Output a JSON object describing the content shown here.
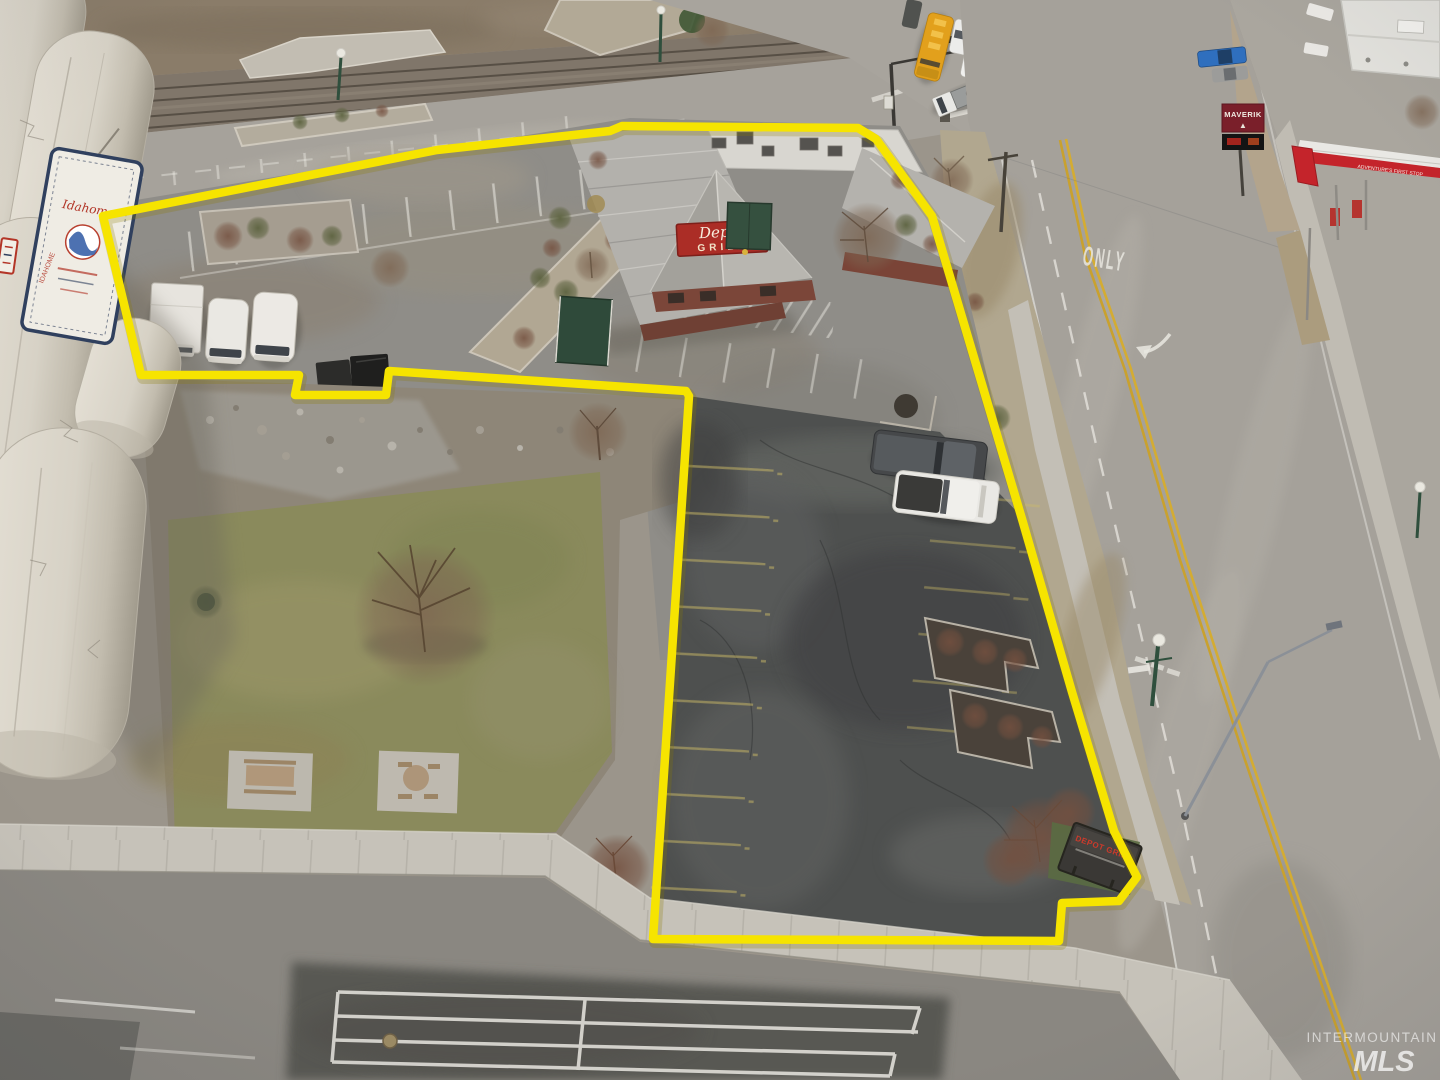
{
  "photo": {
    "type": "aerial-drone-photo",
    "subject": "Commercial property outlined in yellow: Depot Grill restaurant, parking lots, park lawn and grain silos at a street corner"
  },
  "watermark": {
    "line1": "INTERMOUNTAIN",
    "line2": "MLS"
  },
  "boundary": {
    "color": "#f6e400",
    "points": "103,216 437,150 610,131 622,126 858,128 876,139 932,216 1022,519 1072,692 1114,831 1137,877 1119,901 1062,903 1059,941 653,939 689,396 686,391 389,371 386,395 295,395 299,375 141,375"
  },
  "signs": {
    "roof_sign": {
      "script": "Depot",
      "block": "GRILL"
    },
    "monument_sign": {
      "title": "DEPOT GRILL"
    },
    "maverik_sign": {
      "brand": "MAVERIK"
    },
    "canopy_sign": {
      "slogan": "ADVENTURE'S FIRST STOP"
    },
    "silo_banner": {
      "brand": "Idahome"
    }
  },
  "road_markings": {
    "lane_text": "ONLY"
  },
  "icons": {
    "maverik_mountain": "▲",
    "handicap": "♿"
  },
  "colors": {
    "boundary_yellow": "#f6e400",
    "wet_asphalt": "#4e504f",
    "road_gray": "#a6a29b",
    "lawn_green": "#8a8a5c",
    "school_bus_yellow": "#e2a01c",
    "brick_red": "#7a4538",
    "sign_red": "#ab2d26",
    "silo_cream": "#d9d4c9"
  }
}
